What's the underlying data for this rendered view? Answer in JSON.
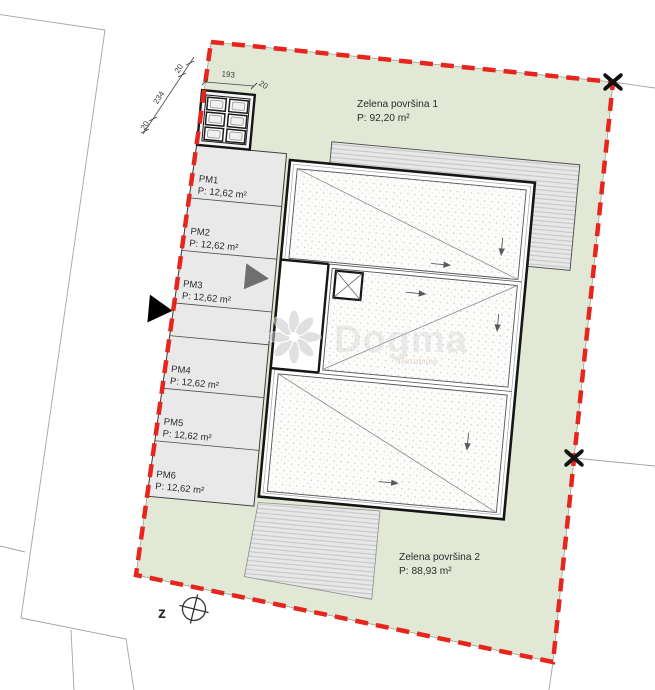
{
  "plan": {
    "green_area_1": {
      "label": "Zelena površina 1",
      "area": "P: 92,20 m²"
    },
    "green_area_2": {
      "label": "Zelena površina 2",
      "area": "P: 88,93 m²"
    },
    "parking_stalls": [
      {
        "id": "PM1",
        "area": "P: 12,62 m²"
      },
      {
        "id": "PM2",
        "area": "P: 12,62 m²"
      },
      {
        "id": "PM3",
        "area": "P: 12,62 m²"
      },
      {
        "id": "PM4",
        "area": "P: 12,62 m²"
      },
      {
        "id": "PM5",
        "area": "P: 12,62 m²"
      },
      {
        "id": "PM6",
        "area": "P: 12,62 m²"
      }
    ],
    "dimensions": {
      "top_width": "193",
      "top_right_offset": "20",
      "left_height": "234",
      "left_upper_offset": "20",
      "left_lower_offset": "20"
    },
    "orientation_label": "z",
    "watermark": {
      "name": "Dogma",
      "tagline": "nekretnine"
    },
    "colors": {
      "boundary_red": "#e7251d",
      "green_fill": "#e1e9d6",
      "parking_fill": "#e9e9e9",
      "roof_fill": "#fcfcfb",
      "hatch_fill": "#e7e7e7"
    }
  }
}
